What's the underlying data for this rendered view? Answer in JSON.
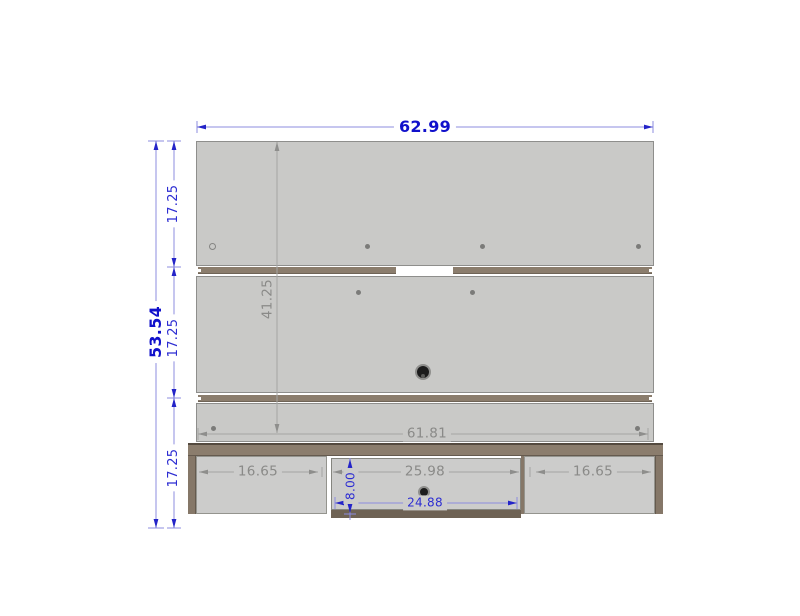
{
  "diagram": {
    "dimensions": {
      "overall_width": "62.99",
      "overall_height": "53.54",
      "top_section_height": "17.25",
      "middle_section_height": "17.25",
      "bottom_section_height": "17.25",
      "panel_height": "41.25",
      "shelf_width": "61.81",
      "left_compartment_width": "16.65",
      "center_compartment_width": "25.98",
      "right_compartment_width": "16.65",
      "drawer_front_height": "8.00",
      "drawer_front_width": "24.88"
    },
    "colors": {
      "dimension_blue": "#1111cb",
      "dimension_gray": "#8a8a88",
      "panel_gray": "#c9c9c7",
      "wood_brown": "#8b7d6d"
    }
  }
}
